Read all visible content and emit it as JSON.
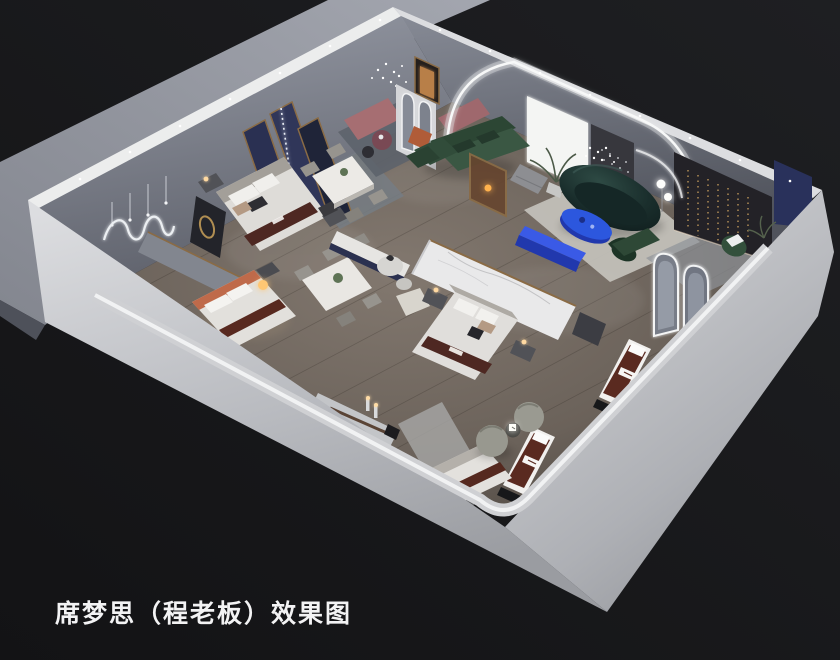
{
  "caption": {
    "text": "席梦思（程老板）效果图"
  },
  "scene": {
    "type": "3d-interior-render",
    "subject": "cutaway axonometric rendering of a mattress / bedding showroom",
    "rooms": [
      "left-bedroom-display",
      "top-bedroom-display",
      "dining-display",
      "living-lounge",
      "right-bedroom-display",
      "mattress-gallery"
    ],
    "objects": [
      "exterior-ground-slab",
      "showroom-shell-walls",
      "wood-plank-floor",
      "gold-framed-navy-divider-panels",
      "wavy-neon-wall-art",
      "pendant-bulb-lights",
      "upholstered-bed-with-logo-runner",
      "terracotta-headboard-bed",
      "glowing-sphere-lamp",
      "marble-dining-table-with-chairs",
      "second-dining-table-with-plant",
      "mauve-display-benches",
      "crystal-bead-chandeliers",
      "round-glass-side-tables",
      "white-console-with-navy-front",
      "pedestal-display-table",
      "marble-display-counter-with-lamps",
      "white-marble-partition-with-gold-trim",
      "center-bed-with-nightstands",
      "arched-niche-partition",
      "warm-lit-doorway",
      "led-cove-arch",
      "backlit-light-panel",
      "potted-palm-plant",
      "sparkle-dot-artwork",
      "dark-accent-wall-with-hanging-gold-lights",
      "navy-corner-panel",
      "green-sectional-sofa",
      "gold-framed-display-cabinet",
      "gray-tufted-pouf",
      "dark-teal-curved-sofa",
      "cobalt-blue-oval-coffee-table",
      "cobalt-blue-console",
      "green-velvet-chair",
      "double-globe-floor-lamp",
      "green-bench-and-armchair",
      "arched-led-mirrors",
      "mattress-display-units-with-brand-runner",
      "swivel-barrel-chairs-with-glowing-cube-table",
      "area-rugs"
    ]
  },
  "palette": {
    "bg": "#1e1f22",
    "bg-deep": "#141416",
    "slab": "#9aa0a9",
    "slab-dark": "#868a94",
    "slab-side": "#4e515a",
    "wall-outer": "#dadbde",
    "wall-outer-mid": "#b4b6bb",
    "wall-outer-deep": "#94969b",
    "wall-top": "#eceded",
    "nw-wall": "#9096a1",
    "nw-wall-deep": "#5f626c",
    "ne-wall": "#80848f",
    "ne-wall-deep": "#53565f",
    "floor": "#7b7168",
    "floor-deep": "#4c453f",
    "aisle": "#a9abae",
    "gold": "#8a6b45",
    "navy-panel": "#2a3052",
    "terracotta": "#bf6a4a",
    "runner": "#4e2822",
    "mattress-brown": "#5a2a20",
    "bed-white": "#e0dedb",
    "headboard": "#aeaaa4",
    "green-sofa": "#2c4634",
    "green-seat": "#3a5743",
    "green-chair": "#1d3426",
    "teal-sofa": "#142424",
    "teal-hi": "#2e4a44",
    "cobalt": "#2c57de",
    "cobalt-deep": "#2138ad",
    "mauve": "#a66e72",
    "wine": "#7c4752",
    "marble": "#e9e9ea",
    "counter": "#c3c5c8",
    "dark-wall": "#232227",
    "curtain": "#37373d",
    "navy-wall": "#29315b",
    "led": "#f7f8f8",
    "warm": "#ffc773",
    "chair": "#97948e",
    "rug-light": "#c6c4be",
    "rug-mid": "#8f9398",
    "rug-dark": "#5d636c",
    "white-panel": "#f4f5f3",
    "plant": "#5e7355",
    "base-black": "#17181a",
    "nightstand": "#515257",
    "console-navy": "#2b3150",
    "cream": "#d8d5cd",
    "arch-fill": "#787d88",
    "arch-inner": "#9aa0ac",
    "wood-cab": "#66452f",
    "orange-chair": "#b05c38",
    "pouf": "#8d8e92"
  }
}
